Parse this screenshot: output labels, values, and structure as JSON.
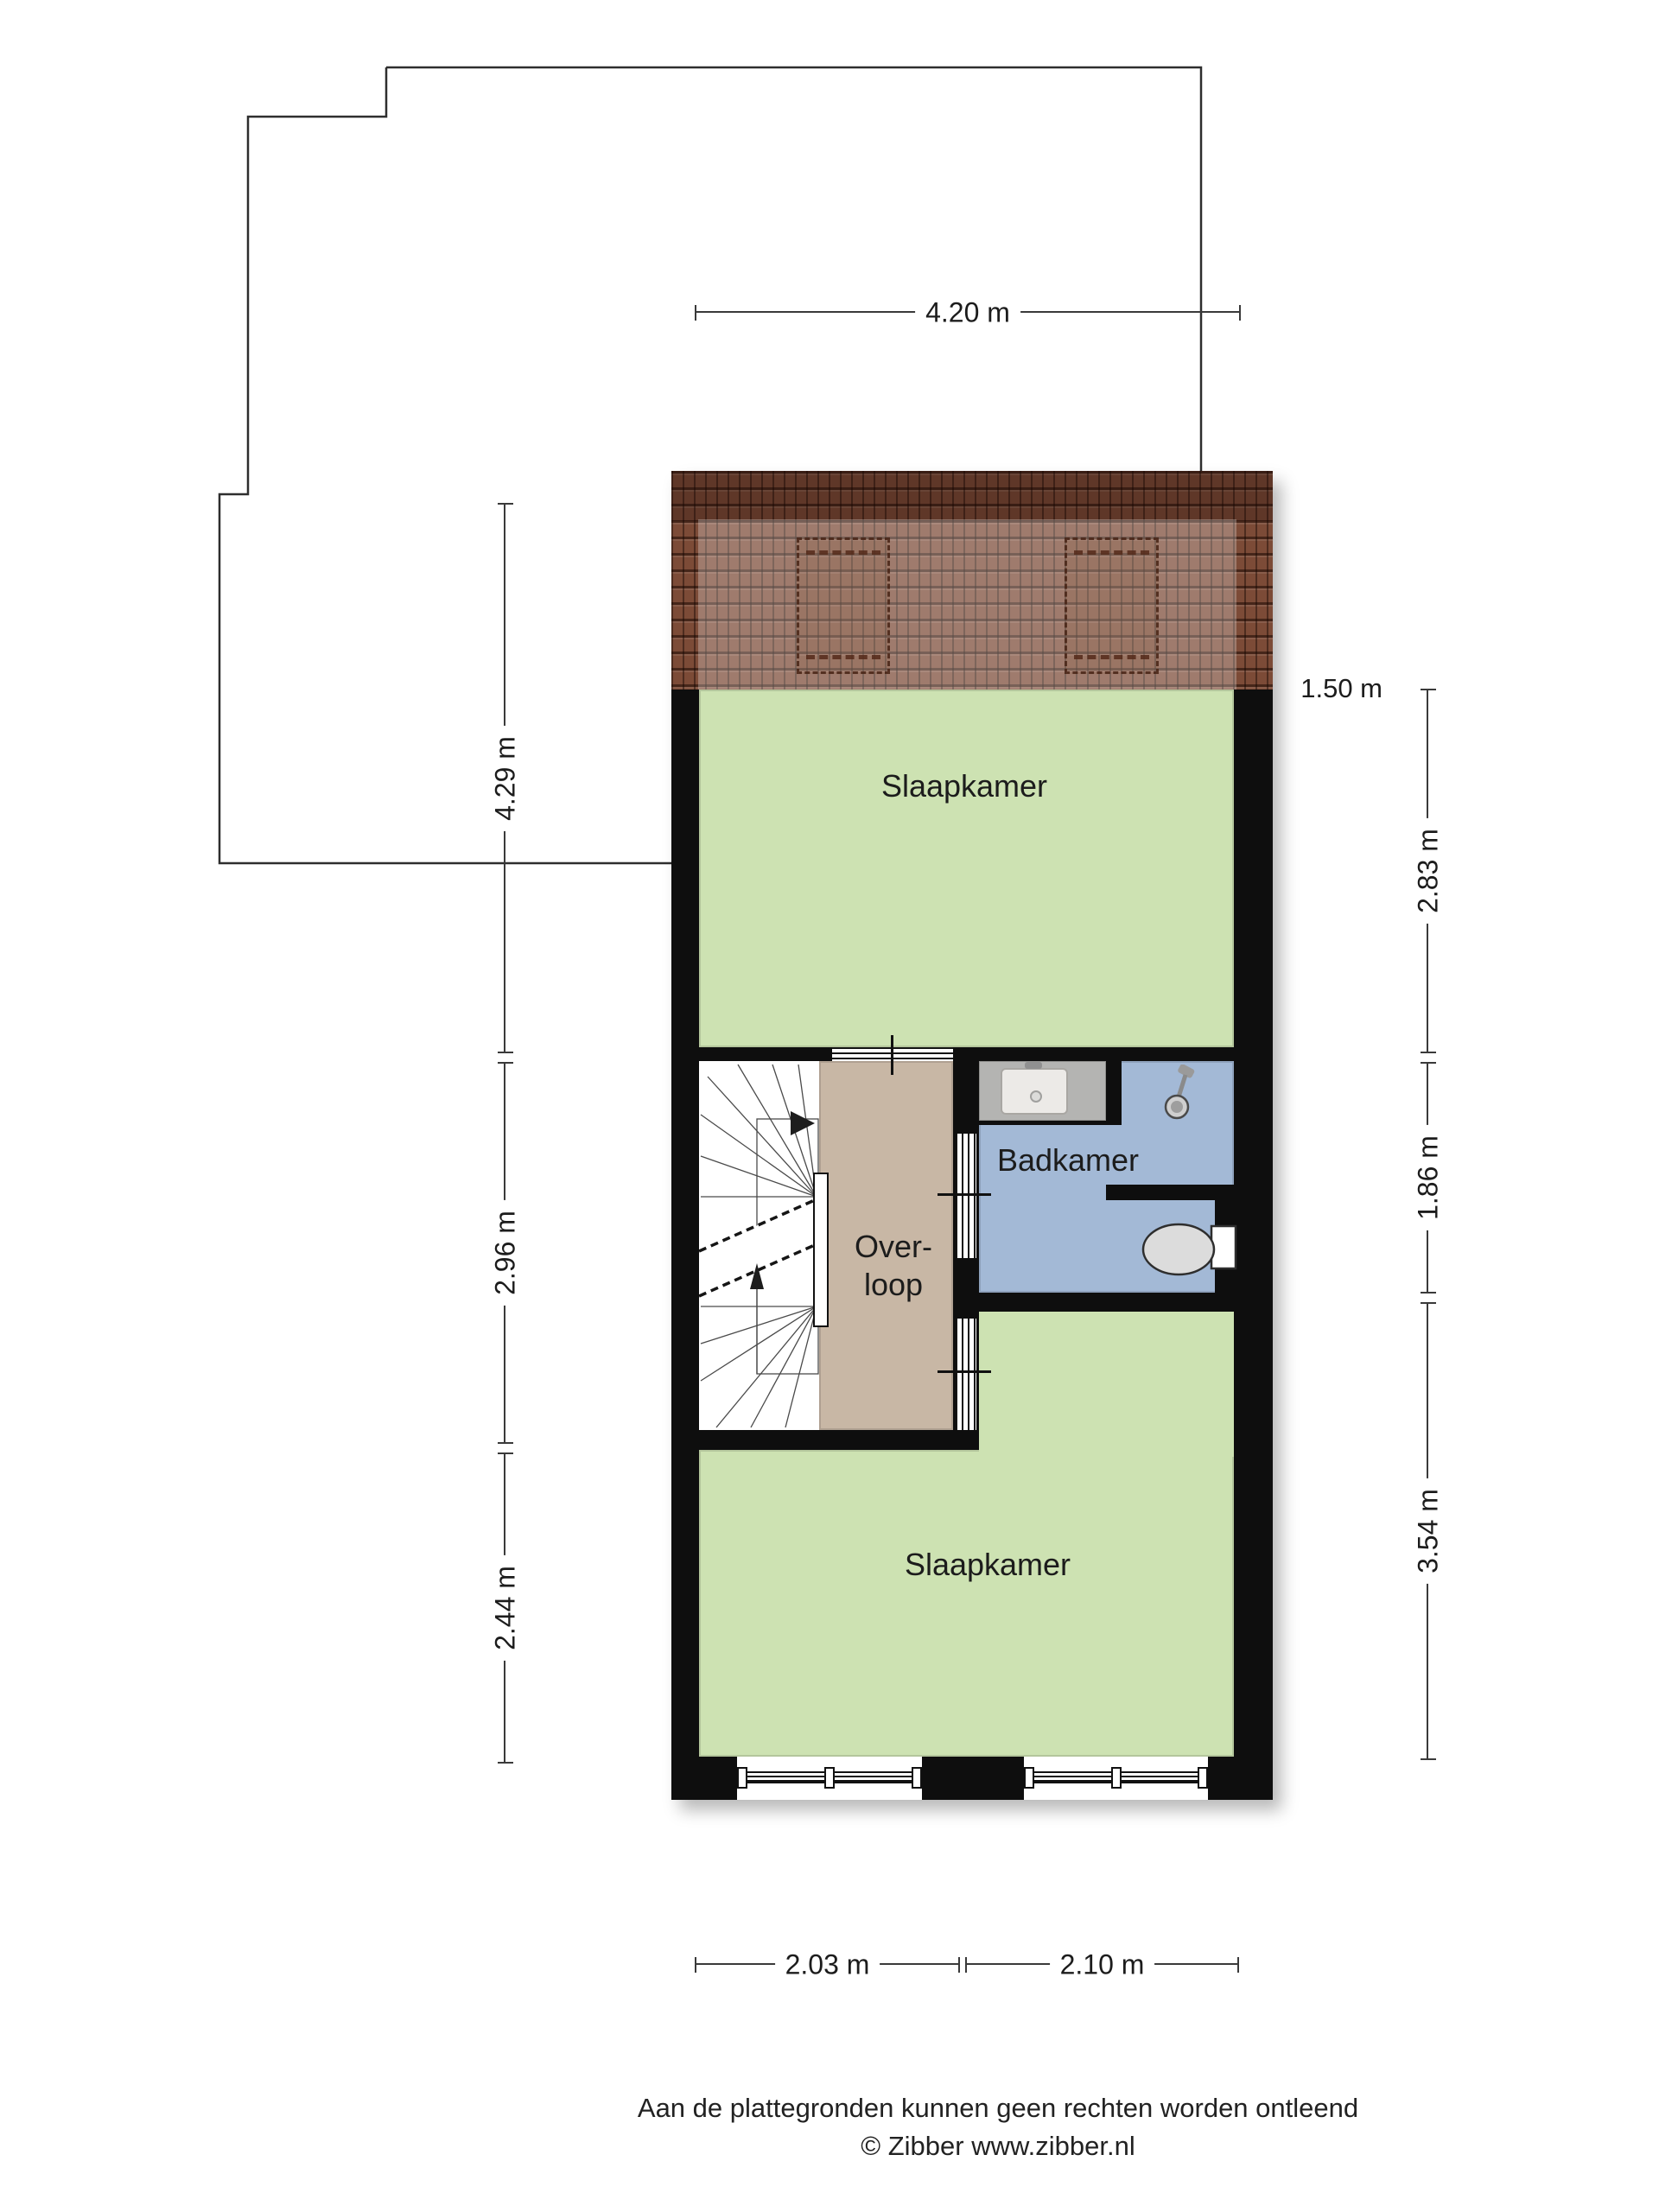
{
  "plan_labels": {
    "bedroom_top": "Slaapkamer",
    "bathroom": "Badkamer",
    "landing_line1": "Over-",
    "landing_line2": "loop",
    "bedroom_bottom": "Slaapkamer"
  },
  "dimensions": {
    "top_width": "4.20 m",
    "left": [
      "4.29 m",
      "2.96 m",
      "2.44 m"
    ],
    "right_roof_depth": "1.50 m",
    "right": [
      "2.83 m",
      "1.86 m",
      "3.54 m"
    ],
    "bottom": [
      "2.03 m",
      "2.10 m"
    ]
  },
  "footer": {
    "disclaimer": "Aan de plattegronden kunnen geen rechten worden ontleend",
    "credit": "© Zibber www.zibber.nl"
  },
  "colors": {
    "bedroom_green": "#cde2b2",
    "bathroom_blue": "#a3b9d6",
    "landing_tan": "#c8b7a5",
    "wall_black": "#0e0e0e",
    "roof_brown": "#7c4b37",
    "counter_grey": "#b4b4b2"
  },
  "icons": {
    "stairs": "stairs-icon",
    "shower": "shower-head-icon",
    "toilet": "toilet-icon",
    "sink": "sink-basin-icon",
    "window": "window-icon",
    "door": "door-opening-icon"
  }
}
